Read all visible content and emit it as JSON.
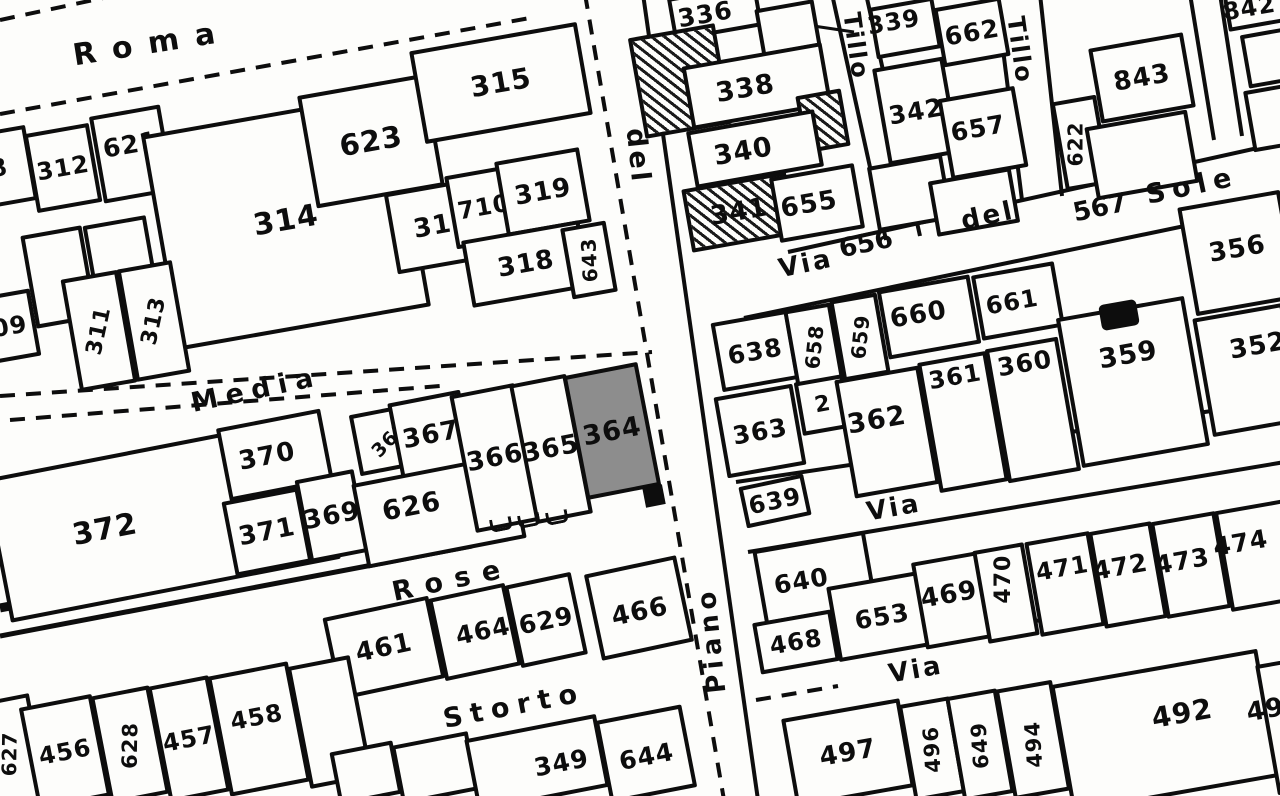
{
  "map": {
    "description_labels": {
      "highlighted_parcel": "364"
    },
    "colors": {
      "ink": "#0d0d0d",
      "paper": "#fdfdfb",
      "highlight_fill": "#8d8d8d"
    },
    "street_labels": [
      {
        "text": "Roma",
        "x": 152,
        "y": 44,
        "rot": -9,
        "size": 30,
        "ls": 16
      },
      {
        "text": "Media",
        "x": 256,
        "y": 390,
        "rot": -12,
        "size": 27,
        "ls": 8
      },
      {
        "text": "Rose",
        "x": 452,
        "y": 580,
        "rot": -12,
        "size": 27,
        "ls": 12
      },
      {
        "text": "Storto",
        "x": 514,
        "y": 706,
        "rot": -11,
        "size": 27,
        "ls": 8
      },
      {
        "text": "del",
        "x": 638,
        "y": 156,
        "rot": 84,
        "size": 27,
        "ls": 3
      },
      {
        "text": "Piano",
        "x": 712,
        "y": 640,
        "rot": -96,
        "size": 26,
        "ls": 5
      },
      {
        "text": "Via",
        "x": 806,
        "y": 264,
        "rot": -12,
        "size": 26,
        "ls": 3
      },
      {
        "text": "del",
        "x": 988,
        "y": 216,
        "rot": -12,
        "size": 26,
        "ls": 3
      },
      {
        "text": "Sole",
        "x": 1192,
        "y": 186,
        "rot": -12,
        "size": 27,
        "ls": 7
      },
      {
        "text": "Tillo",
        "x": 856,
        "y": 46,
        "rot": 82,
        "size": 24,
        "ls": 2
      },
      {
        "text": "Tillo",
        "x": 1020,
        "y": 50,
        "rot": 82,
        "size": 24,
        "ls": 2
      },
      {
        "text": "Via",
        "x": 894,
        "y": 508,
        "rot": -10,
        "size": 26,
        "ls": 3
      },
      {
        "text": "Via",
        "x": 916,
        "y": 670,
        "rot": -10,
        "size": 26,
        "ls": 3
      },
      {
        "text": "656",
        "x": 866,
        "y": 244,
        "rot": -12,
        "size": 26,
        "num": 1
      },
      {
        "text": "567",
        "x": 1100,
        "y": 208,
        "rot": -12,
        "size": 26,
        "num": 1
      }
    ],
    "street_lines": [
      {
        "x1": 0,
        "y1": 20,
        "x2": 150,
        "y2": -12,
        "d": 1
      },
      {
        "x1": 0,
        "y1": 114,
        "x2": 530,
        "y2": 18,
        "d": 1
      },
      {
        "x1": 0,
        "y1": 396,
        "x2": 652,
        "y2": 352,
        "d": 1
      },
      {
        "x1": 10,
        "y1": 420,
        "x2": 440,
        "y2": 386,
        "d": 1
      },
      {
        "x1": 585,
        "y1": -6,
        "x2": 724,
        "y2": 800,
        "d": 1
      },
      {
        "x1": 643,
        "y1": -6,
        "x2": 758,
        "y2": 800
      },
      {
        "x1": 788,
        "y1": 252,
        "x2": 1285,
        "y2": 142
      },
      {
        "x1": 744,
        "y1": 318,
        "x2": 1285,
        "y2": 205
      },
      {
        "x1": 832,
        "y1": -6,
        "x2": 886,
        "y2": 240
      },
      {
        "x1": 866,
        "y1": -6,
        "x2": 920,
        "y2": 236
      },
      {
        "x1": 996,
        "y1": -6,
        "x2": 1022,
        "y2": 200
      },
      {
        "x1": 1040,
        "y1": -6,
        "x2": 1062,
        "y2": 196
      },
      {
        "x1": 1190,
        "y1": -6,
        "x2": 1214,
        "y2": 140
      },
      {
        "x1": 1220,
        "y1": -6,
        "x2": 1242,
        "y2": 136
      },
      {
        "x1": 736,
        "y1": 482,
        "x2": 1285,
        "y2": 400
      },
      {
        "x1": 748,
        "y1": 552,
        "x2": 1285,
        "y2": 462
      },
      {
        "x1": 760,
        "y1": 664,
        "x2": 1285,
        "y2": 582
      },
      {
        "x1": 756,
        "y1": 700,
        "x2": 838,
        "y2": 686,
        "d": 1
      },
      {
        "x1": 0,
        "y1": 636,
        "x2": 472,
        "y2": 546,
        "w": 5
      },
      {
        "x1": 0,
        "y1": 608,
        "x2": 126,
        "y2": 584,
        "w": 9
      },
      {
        "x1": 800,
        "y1": 24,
        "x2": 854,
        "y2": 32,
        "w": 3
      }
    ],
    "parcels": [
      {
        "label": "8",
        "x": -34,
        "y": 130,
        "w": 66,
        "h": 76,
        "rot": -10,
        "size": 24
      },
      {
        "label": "312",
        "x": 30,
        "y": 128,
        "w": 66,
        "h": 80,
        "rot": -10,
        "size": 24
      },
      {
        "label": "621",
        "x": 96,
        "y": 110,
        "w": 72,
        "h": 88,
        "rot": -10,
        "size": 25,
        "ldy": -10
      },
      {
        "label": "314",
        "x": 158,
        "y": 112,
        "w": 256,
        "h": 218,
        "rot": -10,
        "size": 30
      },
      {
        "label": "623",
        "x": 306,
        "y": 84,
        "w": 130,
        "h": 114,
        "rot": -10,
        "size": 29
      },
      {
        "label": "315",
        "x": 416,
        "y": 36,
        "w": 170,
        "h": 94,
        "rot": -10,
        "size": 28
      },
      {
        "label": "317",
        "x": 390,
        "y": 184,
        "w": 104,
        "h": 82,
        "rot": -10,
        "size": 26
      },
      {
        "label": "710",
        "x": 450,
        "y": 170,
        "w": 68,
        "h": 74,
        "rot": -10,
        "size": 24
      },
      {
        "label": "319",
        "x": 500,
        "y": 154,
        "w": 86,
        "h": 76,
        "rot": -10,
        "size": 26
      },
      {
        "label": "318",
        "x": 466,
        "y": 230,
        "w": 120,
        "h": 68,
        "rot": -10,
        "size": 26
      },
      {
        "label": "643",
        "x": 566,
        "y": 224,
        "w": 46,
        "h": 72,
        "rot": -10,
        "size": 20,
        "lrot": -83
      },
      {
        "label": "309",
        "x": -34,
        "y": 294,
        "w": 70,
        "h": 68,
        "rot": -10,
        "size": 24
      },
      {
        "label": "",
        "x": 28,
        "y": 230,
        "w": 62,
        "h": 94,
        "rot": -10
      },
      {
        "label": "",
        "x": 90,
        "y": 220,
        "w": 64,
        "h": 92,
        "rot": -10
      },
      {
        "label": "311",
        "x": 70,
        "y": 274,
        "w": 58,
        "h": 114,
        "rot": -10,
        "size": 22,
        "lrot": -68
      },
      {
        "label": "313",
        "x": 126,
        "y": 264,
        "w": 56,
        "h": 114,
        "rot": -10,
        "size": 22,
        "lrot": -68
      },
      {
        "label": "372",
        "x": -6,
        "y": 446,
        "w": 336,
        "h": 146,
        "rot": -11,
        "size": 30,
        "ldx": -58
      },
      {
        "label": "370",
        "x": 222,
        "y": 418,
        "w": 106,
        "h": 74,
        "rot": -11,
        "size": 26,
        "ldx": -8
      },
      {
        "label": "371",
        "x": 228,
        "y": 494,
        "w": 78,
        "h": 76,
        "rot": -11,
        "size": 26
      },
      {
        "label": "369",
        "x": 302,
        "y": 474,
        "w": 60,
        "h": 84,
        "rot": -11,
        "size": 26
      },
      {
        "label": "368",
        "x": 354,
        "y": 408,
        "w": 72,
        "h": 62,
        "rot": -11,
        "size": 19,
        "lrot": -35
      },
      {
        "label": "367",
        "x": 394,
        "y": 396,
        "w": 74,
        "h": 78,
        "rot": -11,
        "size": 26
      },
      {
        "label": "626",
        "x": 358,
        "y": 468,
        "w": 162,
        "h": 86,
        "rot": -11,
        "size": 27,
        "ldx": -26,
        "ldy": -10
      },
      {
        "label": "366",
        "x": 462,
        "y": 388,
        "w": 66,
        "h": 140,
        "rot": -11,
        "size": 26
      },
      {
        "label": "365",
        "x": 522,
        "y": 378,
        "w": 58,
        "h": 142,
        "rot": -11,
        "size": 26
      },
      {
        "label": "364",
        "x": 574,
        "y": 368,
        "w": 76,
        "h": 126,
        "rot": -11,
        "size": 27,
        "fill": "gray"
      },
      {
        "label": "461",
        "x": 330,
        "y": 606,
        "w": 108,
        "h": 84,
        "rot": -12,
        "size": 26
      },
      {
        "label": "464",
        "x": 436,
        "y": 590,
        "w": 78,
        "h": 84,
        "rot": -12,
        "size": 25,
        "ldx": 8
      },
      {
        "label": "629",
        "x": 512,
        "y": 578,
        "w": 68,
        "h": 84,
        "rot": -12,
        "size": 25
      },
      {
        "label": "466",
        "x": 592,
        "y": 564,
        "w": 94,
        "h": 88,
        "rot": -12,
        "size": 26,
        "ldy": 4
      },
      {
        "label": "627",
        "x": -22,
        "y": 698,
        "w": 62,
        "h": 112,
        "rot": -11,
        "size": 20,
        "lrot": -78
      },
      {
        "label": "456",
        "x": 28,
        "y": 700,
        "w": 74,
        "h": 104,
        "rot": -11,
        "size": 24
      },
      {
        "label": "628",
        "x": 100,
        "y": 690,
        "w": 60,
        "h": 110,
        "rot": -11,
        "size": 21,
        "lrot": -78
      },
      {
        "label": "457",
        "x": 158,
        "y": 680,
        "w": 62,
        "h": 118,
        "rot": -11,
        "size": 24
      },
      {
        "label": "458",
        "x": 218,
        "y": 668,
        "w": 82,
        "h": 122,
        "rot": -11,
        "size": 24,
        "ldy": -12
      },
      {
        "label": "",
        "x": 298,
        "y": 660,
        "w": 64,
        "h": 124,
        "rot": -11
      },
      {
        "label": "",
        "x": 334,
        "y": 746,
        "w": 64,
        "h": 54,
        "rot": -11
      },
      {
        "label": "",
        "x": 396,
        "y": 738,
        "w": 78,
        "h": 60,
        "rot": -11
      },
      {
        "label": "349",
        "x": 470,
        "y": 726,
        "w": 134,
        "h": 74,
        "rot": -11,
        "size": 25,
        "ldx": 24,
        "ldy": 4
      },
      {
        "label": "644",
        "x": 602,
        "y": 712,
        "w": 88,
        "h": 84,
        "rot": -11,
        "size": 25,
        "ldy": 2
      },
      {
        "label": "336",
        "x": 670,
        "y": -10,
        "w": 90,
        "h": 44,
        "rot": -10,
        "size": 25,
        "ldx": -10
      },
      {
        "label": "",
        "x": 758,
        "y": 4,
        "w": 60,
        "h": 48,
        "rot": -10
      },
      {
        "label": "",
        "x": 636,
        "y": 30,
        "w": 88,
        "h": 102,
        "rot": -10,
        "hatch": 1
      },
      {
        "label": "338",
        "x": 686,
        "y": 54,
        "w": 142,
        "h": 64,
        "rot": -10,
        "size": 27,
        "ldx": -12
      },
      {
        "label": "",
        "x": 800,
        "y": 92,
        "w": 46,
        "h": 58,
        "rot": -10,
        "hatch": 1
      },
      {
        "label": "340",
        "x": 690,
        "y": 120,
        "w": 130,
        "h": 58,
        "rot": -10,
        "size": 27,
        "ldx": -12
      },
      {
        "label": "341",
        "x": 686,
        "y": 180,
        "w": 106,
        "h": 64,
        "rot": -10,
        "size": 26,
        "hatch": 1
      },
      {
        "label": "655",
        "x": 774,
        "y": 170,
        "w": 86,
        "h": 66,
        "rot": -10,
        "size": 26,
        "ldx": -8
      },
      {
        "label": "339",
        "x": 872,
        "y": 2,
        "w": 66,
        "h": 52,
        "rot": -10,
        "size": 24,
        "ldx": -10,
        "ldy": -8
      },
      {
        "label": "342",
        "x": 880,
        "y": 62,
        "w": 72,
        "h": 98,
        "rot": -10,
        "size": 25
      },
      {
        "label": "",
        "x": 872,
        "y": 160,
        "w": 76,
        "h": 66,
        "rot": -10
      },
      {
        "label": "662",
        "x": 938,
        "y": 2,
        "w": 68,
        "h": 60,
        "rot": -10,
        "size": 25
      },
      {
        "label": "657",
        "x": 944,
        "y": 92,
        "w": 78,
        "h": 82,
        "rot": -10,
        "size": 25,
        "ldx": -4,
        "ldy": -6
      },
      {
        "label": "",
        "x": 932,
        "y": 174,
        "w": 84,
        "h": 56,
        "rot": -10
      },
      {
        "label": "622",
        "x": 1058,
        "y": 98,
        "w": 46,
        "h": 90,
        "rot": -10,
        "size": 20,
        "lrot": -80,
        "ldx": -6
      },
      {
        "label": "843",
        "x": 1094,
        "y": 40,
        "w": 96,
        "h": 76,
        "rot": -10,
        "size": 26
      },
      {
        "label": "",
        "x": 1090,
        "y": 118,
        "w": 104,
        "h": 74,
        "rot": -10
      },
      {
        "label": "842",
        "x": 1224,
        "y": -26,
        "w": 72,
        "h": 52,
        "rot": -10,
        "size": 24,
        "ldx": -12,
        "ldy": 6
      },
      {
        "label": "",
        "x": 1244,
        "y": 30,
        "w": 58,
        "h": 54,
        "rot": -10
      },
      {
        "label": "",
        "x": 1248,
        "y": 86,
        "w": 56,
        "h": 62,
        "rot": -10
      },
      {
        "label": "638",
        "x": 716,
        "y": 316,
        "w": 78,
        "h": 70,
        "rot": -10,
        "size": 25
      },
      {
        "label": "658",
        "x": 790,
        "y": 306,
        "w": 48,
        "h": 82,
        "rot": -10,
        "size": 20,
        "lrot": -74
      },
      {
        "label": "659",
        "x": 836,
        "y": 296,
        "w": 48,
        "h": 82,
        "rot": -10,
        "size": 20,
        "lrot": -74
      },
      {
        "label": "660",
        "x": 882,
        "y": 282,
        "w": 94,
        "h": 70,
        "rot": -10,
        "size": 26,
        "ldx": -10,
        "ldy": -4
      },
      {
        "label": "661",
        "x": 976,
        "y": 268,
        "w": 84,
        "h": 66,
        "rot": -10,
        "size": 24,
        "ldx": -6
      },
      {
        "label": "363",
        "x": 720,
        "y": 390,
        "w": 80,
        "h": 82,
        "rot": -10,
        "size": 25
      },
      {
        "label": "2",
        "x": 798,
        "y": 378,
        "w": 50,
        "h": 54,
        "rot": -10,
        "size": 22
      },
      {
        "label": "362",
        "x": 844,
        "y": 372,
        "w": 86,
        "h": 120,
        "rot": -10,
        "size": 27,
        "ldx": -8,
        "ldy": -14
      },
      {
        "label": "361",
        "x": 928,
        "y": 356,
        "w": 70,
        "h": 132,
        "rot": -10,
        "size": 24,
        "ldy": -46
      },
      {
        "label": "360",
        "x": 996,
        "y": 342,
        "w": 74,
        "h": 136,
        "rot": -10,
        "size": 25,
        "ldy": -48
      },
      {
        "label": "359",
        "x": 1068,
        "y": 306,
        "w": 130,
        "h": 152,
        "rot": -10,
        "size": 27,
        "ldy": -28
      },
      {
        "label": "356",
        "x": 1186,
        "y": 198,
        "w": 104,
        "h": 110,
        "rot": -10,
        "size": 26,
        "ldy": -4
      },
      {
        "label": "352",
        "x": 1202,
        "y": 310,
        "w": 92,
        "h": 120,
        "rot": -10,
        "size": 26,
        "ldx": 14,
        "ldy": -22
      },
      {
        "label": "639",
        "x": 742,
        "y": 480,
        "w": 66,
        "h": 42,
        "rot": -12,
        "size": 24
      },
      {
        "label": "640",
        "x": 758,
        "y": 540,
        "w": 114,
        "h": 76,
        "rot": -10,
        "size": 25,
        "ldx": -14
      },
      {
        "label": "468",
        "x": 756,
        "y": 616,
        "w": 80,
        "h": 52,
        "rot": -10,
        "size": 24
      },
      {
        "label": "653",
        "x": 832,
        "y": 578,
        "w": 100,
        "h": 76,
        "rot": -10,
        "size": 25
      },
      {
        "label": "469",
        "x": 918,
        "y": 556,
        "w": 72,
        "h": 88,
        "rot": -10,
        "size": 26,
        "ldx": -4,
        "ldy": -6
      },
      {
        "label": "470",
        "x": 980,
        "y": 546,
        "w": 52,
        "h": 94,
        "rot": -10,
        "size": 22,
        "lrot": -80,
        "ldy": -14
      },
      {
        "label": "471",
        "x": 1032,
        "y": 536,
        "w": 66,
        "h": 96,
        "rot": -10,
        "size": 24,
        "ldy": -16
      },
      {
        "label": "472",
        "x": 1096,
        "y": 526,
        "w": 64,
        "h": 98,
        "rot": -10,
        "size": 25,
        "ldx": -6,
        "ldy": -10
      },
      {
        "label": "473",
        "x": 1158,
        "y": 516,
        "w": 66,
        "h": 98,
        "rot": -10,
        "size": 25,
        "ldx": -8,
        "ldy": -6
      },
      {
        "label": "474",
        "x": 1222,
        "y": 504,
        "w": 78,
        "h": 102,
        "rot": -10,
        "size": 25,
        "ldx": -18,
        "ldy": -16
      },
      {
        "label": "497",
        "x": 788,
        "y": 708,
        "w": 120,
        "h": 90,
        "rot": -10,
        "size": 26
      },
      {
        "label": "496",
        "x": 906,
        "y": 700,
        "w": 52,
        "h": 98,
        "rot": -10,
        "size": 21,
        "lrot": -84
      },
      {
        "label": "649",
        "x": 954,
        "y": 692,
        "w": 52,
        "h": 106,
        "rot": -10,
        "size": 21,
        "lrot": -84
      },
      {
        "label": "494",
        "x": 1004,
        "y": 684,
        "w": 58,
        "h": 112,
        "rot": -10,
        "size": 21,
        "lrot": -84,
        "ldy": 4
      },
      {
        "label": "492",
        "x": 1060,
        "y": 666,
        "w": 210,
        "h": 130,
        "rot": -10,
        "size": 28,
        "ldx": 20,
        "ldy": -14
      },
      {
        "label": "493",
        "x": 1266,
        "y": 658,
        "w": 72,
        "h": 132,
        "rot": -10,
        "size": 26,
        "ldx": -24,
        "ldy": -20
      }
    ],
    "marks": [
      {
        "type": "building",
        "x": 1100,
        "y": 302,
        "w": 38,
        "h": 26,
        "rot": -10
      },
      {
        "type": "square",
        "x": 644,
        "y": 486,
        "w": 20,
        "h": 20,
        "rot": -11
      },
      {
        "type": "tick",
        "x": 490,
        "y": 518,
        "w": 16,
        "h": 10,
        "rot": -11
      },
      {
        "type": "tick",
        "x": 518,
        "y": 514,
        "w": 16,
        "h": 10,
        "rot": -11
      },
      {
        "type": "tick",
        "x": 546,
        "y": 511,
        "w": 16,
        "h": 10,
        "rot": -11
      }
    ]
  }
}
